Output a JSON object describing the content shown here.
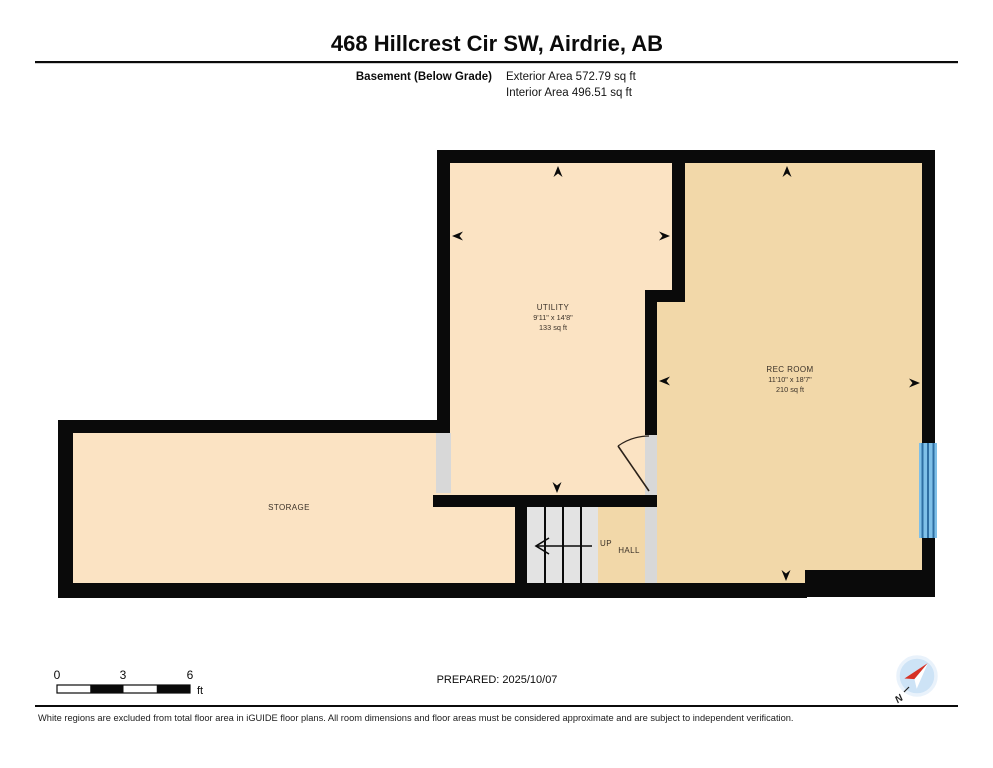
{
  "header": {
    "title": "468 Hillcrest Cir SW, Airdrie, AB",
    "floor_label": "Basement (Below Grade)",
    "exterior_area": "Exterior Area 572.79 sq ft",
    "interior_area": "Interior Area 496.51 sq ft"
  },
  "floor_plan": {
    "rooms": [
      {
        "name": "UTILITY",
        "dimensions": "9'11\" x 14'8\"",
        "area": "133 sq ft"
      },
      {
        "name": "REC ROOM",
        "dimensions": "11'10\" x 18'7\"",
        "area": "210 sq ft"
      },
      {
        "name": "STORAGE",
        "dimensions": "",
        "area": ""
      },
      {
        "name": "HALL",
        "dimensions": "",
        "area": ""
      }
    ],
    "stairs_label": "UP",
    "colors": {
      "wall": "#0A0A0A",
      "room_cream": "#FBE3C3",
      "room_tan": "#F2D8A9",
      "opening_gray": "#D8D8D8",
      "stairs_gray": "#E3E3E3",
      "window_blue": "#7FC0E8",
      "window_blue_dark": "#2F6FA3",
      "compass_blue": "#CDE3F6",
      "compass_red": "#D63125"
    }
  },
  "footer": {
    "scale": {
      "start": "0",
      "mid": "3",
      "end": "6",
      "unit": "ft"
    },
    "prepared": "PREPARED: 2025/10/07",
    "compass_label": "N",
    "disclaimer": "White regions are excluded from total floor area in iGUIDE floor plans. All room dimensions and floor areas must be considered approximate and are subject to independent verification."
  }
}
